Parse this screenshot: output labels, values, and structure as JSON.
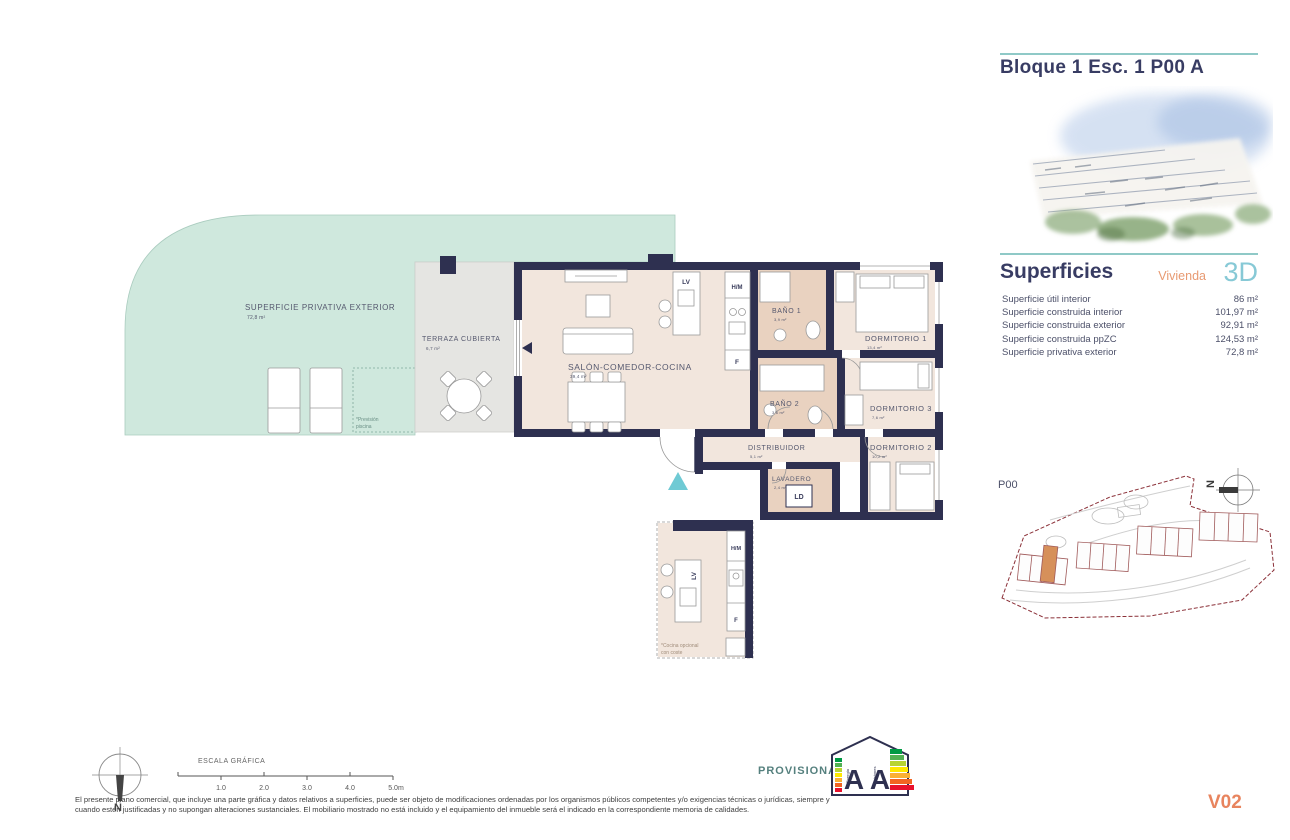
{
  "header": {
    "title": "Bloque 1 Esc. 1 P00 A"
  },
  "superficies": {
    "title": "Superficies",
    "vivienda_label": "Vivienda",
    "type_label": "3D",
    "rows": [
      {
        "label": "Superficie útil interior",
        "value": "86 m²"
      },
      {
        "label": "Superficie construida interior",
        "value": "101,97 m²"
      },
      {
        "label": "Superficie construida exterior",
        "value": "92,91 m²"
      },
      {
        "label": "Superficie construida ppZC",
        "value": "124,53 m²"
      },
      {
        "label": "Superficie privativa exterior",
        "value": "72,8 m²"
      }
    ]
  },
  "plan": {
    "rooms": [
      {
        "label": "SUPERFICIE PRIVATIVA EXTERIOR",
        "area": "72,8 m²"
      },
      {
        "label": "TERRAZA CUBIERTA",
        "area": "6,7 m²"
      },
      {
        "label": "SALÓN-COMEDOR-COCINA",
        "area": "39,4 m²"
      },
      {
        "label": "BAÑO 1",
        "area": "3,9 m²"
      },
      {
        "label": "DORMITORIO 1",
        "area": "13,4 m²"
      },
      {
        "label": "BAÑO 2",
        "area": "3,6 m²"
      },
      {
        "label": "DORMITORIO 3",
        "area": "7,6 m²"
      },
      {
        "label": "DISTRIBUIDOR",
        "area": "5,1 m²"
      },
      {
        "label": "DORMITORIO 2",
        "area": "10,2 m²"
      },
      {
        "label": "LAVADERO",
        "area": "2,4 m²"
      }
    ],
    "appliances": {
      "lv": "LV",
      "hm": "H/M",
      "f": "F",
      "ld": "LD"
    },
    "notes": {
      "pool_line1": "*Previsión",
      "pool_line2": "piscina",
      "kitchen_line1": "*Cocina opcional",
      "kitchen_line2": "con coste"
    }
  },
  "siteplan": {
    "floor_label": "P00",
    "north_label": "N"
  },
  "footer": {
    "scale_title": "ESCALA GRÁFICA",
    "scale_ticks": [
      "1.0",
      "2.0",
      "3.0",
      "4.0",
      "5.0m"
    ],
    "provisional": "PROVISIONAL",
    "energy": {
      "letter1": "A",
      "letter2": "A",
      "left_caption": "Energía",
      "right_caption": "Emisiones"
    },
    "disclaimer_line1": "El presente plano comercial, que incluye una parte gráfica y datos relativos a superficies, puede ser objeto de modificaciones ordenadas por los organismos públicos competentes y/o exigencias técnicas o jurídicas, siempre y",
    "disclaimer_line2": "cuando estén justificadas y no supongan alteraciones sustanciales. El mobiliario mostrado no está incluido y el equipamiento del inmueble será el indicado en la correspondiente memoria de calidades.",
    "version": "V02",
    "north_label": "N"
  },
  "colors": {
    "navy": "#2e3050",
    "teal": "#8fc9c7",
    "mint": "#cfe8dd",
    "beige": "#f2e6dd",
    "tan": "#e9d2c0",
    "orange": "#e89a72",
    "lightblue": "#87c9d6",
    "site_red": "#8b3038",
    "building_orange": "#d6905a",
    "version_orange": "#e8845e"
  }
}
